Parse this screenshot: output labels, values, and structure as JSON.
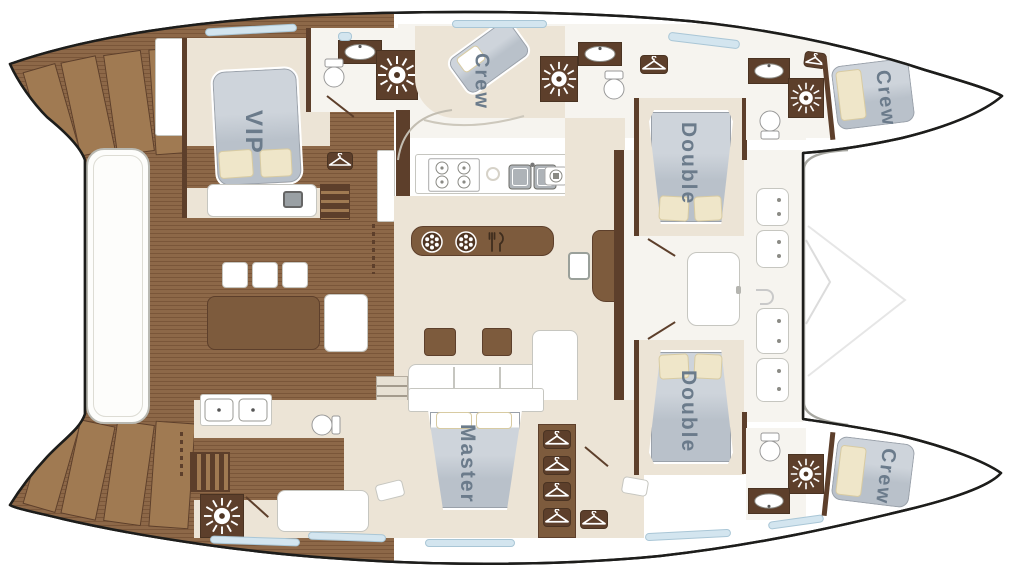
{
  "meta": {
    "type": "catamaran-yacht-deck-plan"
  },
  "colors": {
    "outline": "#1d1d1b",
    "wood": "#8d6848",
    "wood_line": "#7a5639",
    "wood_mid": "#7d5b3d",
    "wood_dark": "#5d3f2b",
    "wood_step": "#a07a52",
    "floor": "#ece4d6",
    "floor_light": "#f6f4ef",
    "bed": "#b9c1ca",
    "bed_light": "#ced4db",
    "pillow": "#efe6c9",
    "window_fill": "#d3e5ef",
    "window_line": "#a9c6d6",
    "label": "#6b7b8b"
  },
  "cabins": {
    "vip": {
      "label": "VIP"
    },
    "crew_mid": {
      "label": "Crew"
    },
    "double_top": {
      "label": "Double"
    },
    "double_bottom": {
      "label": "Double"
    },
    "master": {
      "label": "Master"
    },
    "crew_bow_top": {
      "label": "Crew"
    },
    "crew_bow_bottom": {
      "label": "Crew"
    }
  },
  "icons": [
    "shower-icon",
    "hanger-icon",
    "vent-wheel-icon",
    "cutlery-icon",
    "stove-icon",
    "sink-icon",
    "toilet-icon",
    "stairs",
    "hull-window"
  ]
}
